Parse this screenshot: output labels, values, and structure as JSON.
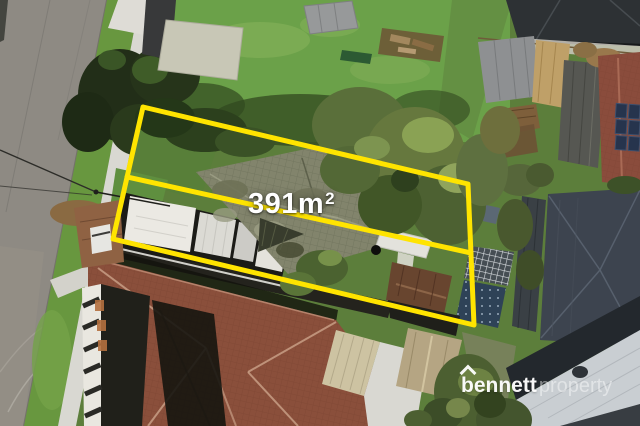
{
  "overlay": {
    "area_value": "391m",
    "area_exponent": "2"
  },
  "watermark": {
    "brand_primary": "bennett",
    "brand_secondary": "property"
  },
  "palette": {
    "boundary_yellow": "#FFE400",
    "area_label_white": "#FFFFFF",
    "watermark_white": "#FFFFFF"
  }
}
